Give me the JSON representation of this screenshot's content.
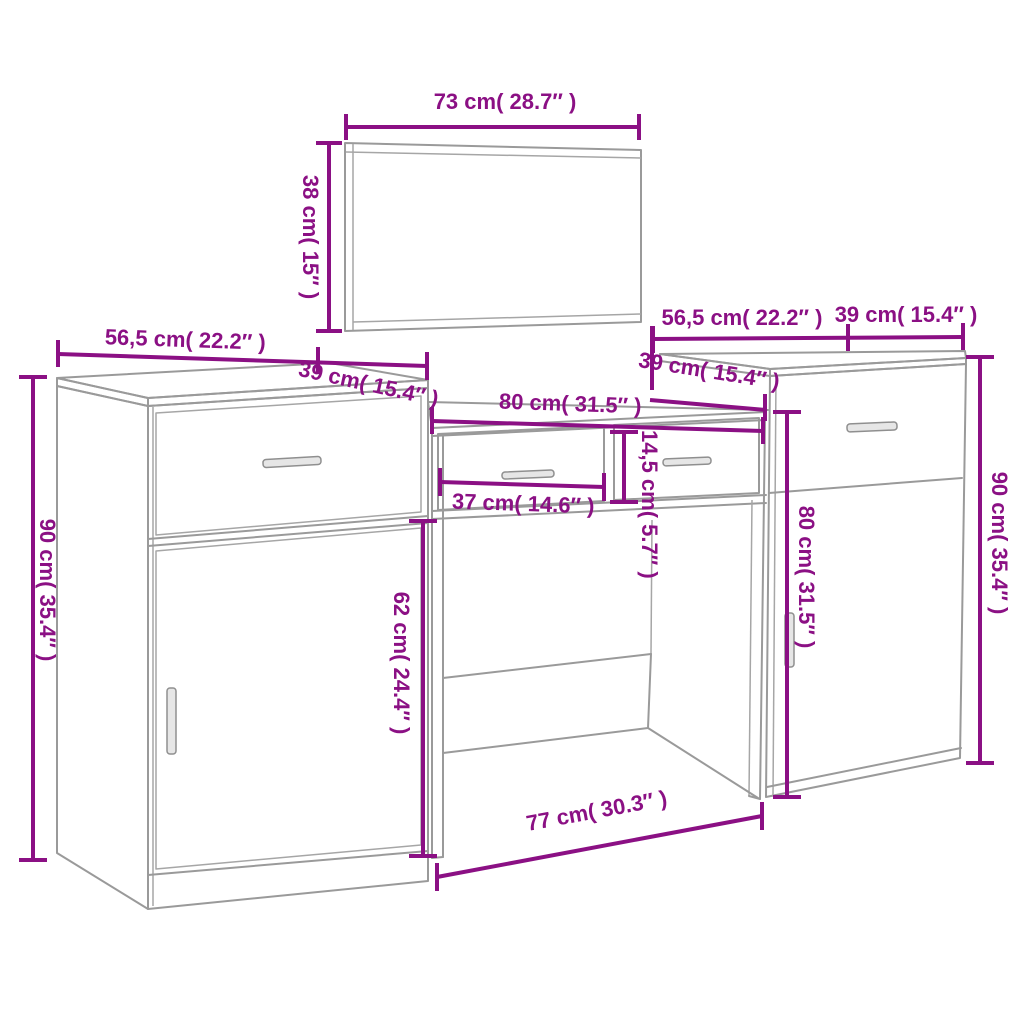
{
  "colors": {
    "dimension": "#8B1084",
    "furniture_line": "#9A9A9A",
    "handle_fill": "#E6E6E6",
    "background": "#FFFFFF"
  },
  "diagram": {
    "mirror": {
      "width_label": "73 cm( 28.7″ )",
      "height_label": "38 cm( 15″ )"
    },
    "left_cabinet": {
      "width_label": "56,5 cm( 22.2″ )",
      "depth_label": "39 cm( 15.4″ )",
      "height_label": "90 cm( 35.4″ )"
    },
    "dressing_table": {
      "top_width_label": "80 cm( 31.5″ )",
      "depth_label": "39 cm( 15.4″ )",
      "drawer_width_label": "37 cm( 14.6″ )",
      "drawer_height_label": "14,5 cm( 5.7″ )",
      "clearance_height_label": "62 cm( 24.4″ )",
      "base_width_label": "77 cm( 30.3″ )"
    },
    "right_cabinet": {
      "width_label": "56,5 cm( 22.2″ )",
      "depth_label": "39 cm( 15.4″ )",
      "door_height_label": "80 cm( 31.5″ )",
      "height_label": "90 cm( 35.4″ )"
    }
  }
}
